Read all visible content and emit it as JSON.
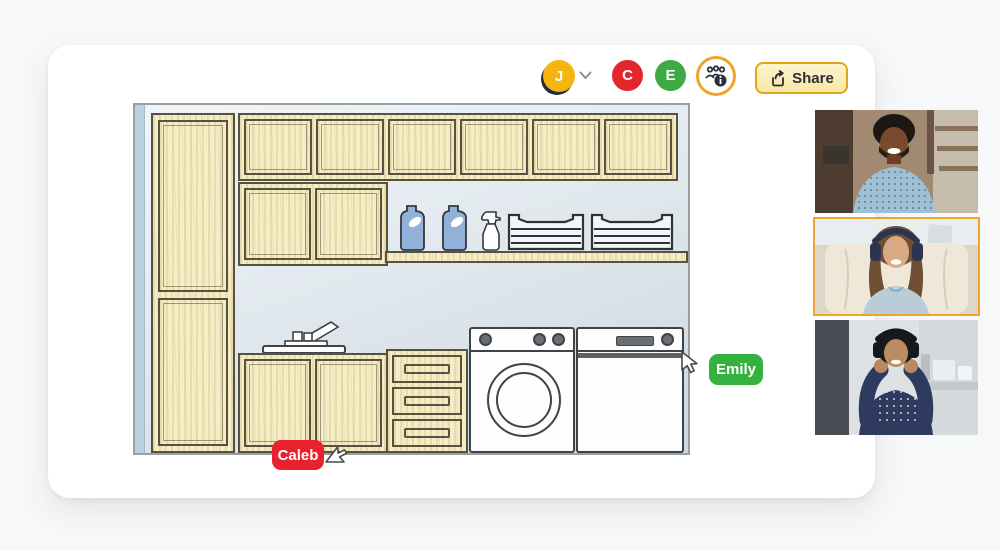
{
  "window": {
    "background": "#f7f8f9",
    "card_color": "#ffffff"
  },
  "toolbar": {
    "avatars": [
      {
        "initial": "J",
        "color": "#f6b40e",
        "has_dropdown": true
      },
      {
        "initial": "C",
        "color": "#e3262a"
      },
      {
        "initial": "E",
        "color": "#3fa945"
      }
    ],
    "members_button_icon": "group-members-info-icon",
    "share": {
      "label": "Share",
      "icon": "share-forward-icon",
      "accent": "#dfa61c"
    }
  },
  "canvas": {
    "scene": "laundry-room-elevation-drawing",
    "wall_color": "#dde6ec",
    "cabinet_color": "#f4edc6",
    "items": [
      "tall-cabinet",
      "upper-cabinet-row",
      "wall-cabinet",
      "open-shelf",
      "detergent-jug-1",
      "detergent-jug-2",
      "spray-bottle",
      "wire-basket-1",
      "wire-basket-2",
      "faucet",
      "sink-counter",
      "sink-cabinet",
      "drawer-unit",
      "washing-machine",
      "dryer"
    ]
  },
  "collaborators": {
    "cursors": [
      {
        "name": "Caleb",
        "color": "#e8212f"
      },
      {
        "name": "Emily",
        "color": "#35b13f"
      }
    ]
  },
  "video_call": {
    "active_tile_border": "#f0a32f",
    "tiles": [
      {
        "id": "participant-1",
        "description": "smiling man with curly hair, light blue shirt, cafe background",
        "active": false
      },
      {
        "id": "participant-2",
        "description": "smiling woman with headphones in cream armchair",
        "active": true
      },
      {
        "id": "participant-3",
        "description": "woman adjusting headphones, navy polka-dot shirt, kitchen background",
        "active": false
      }
    ]
  }
}
